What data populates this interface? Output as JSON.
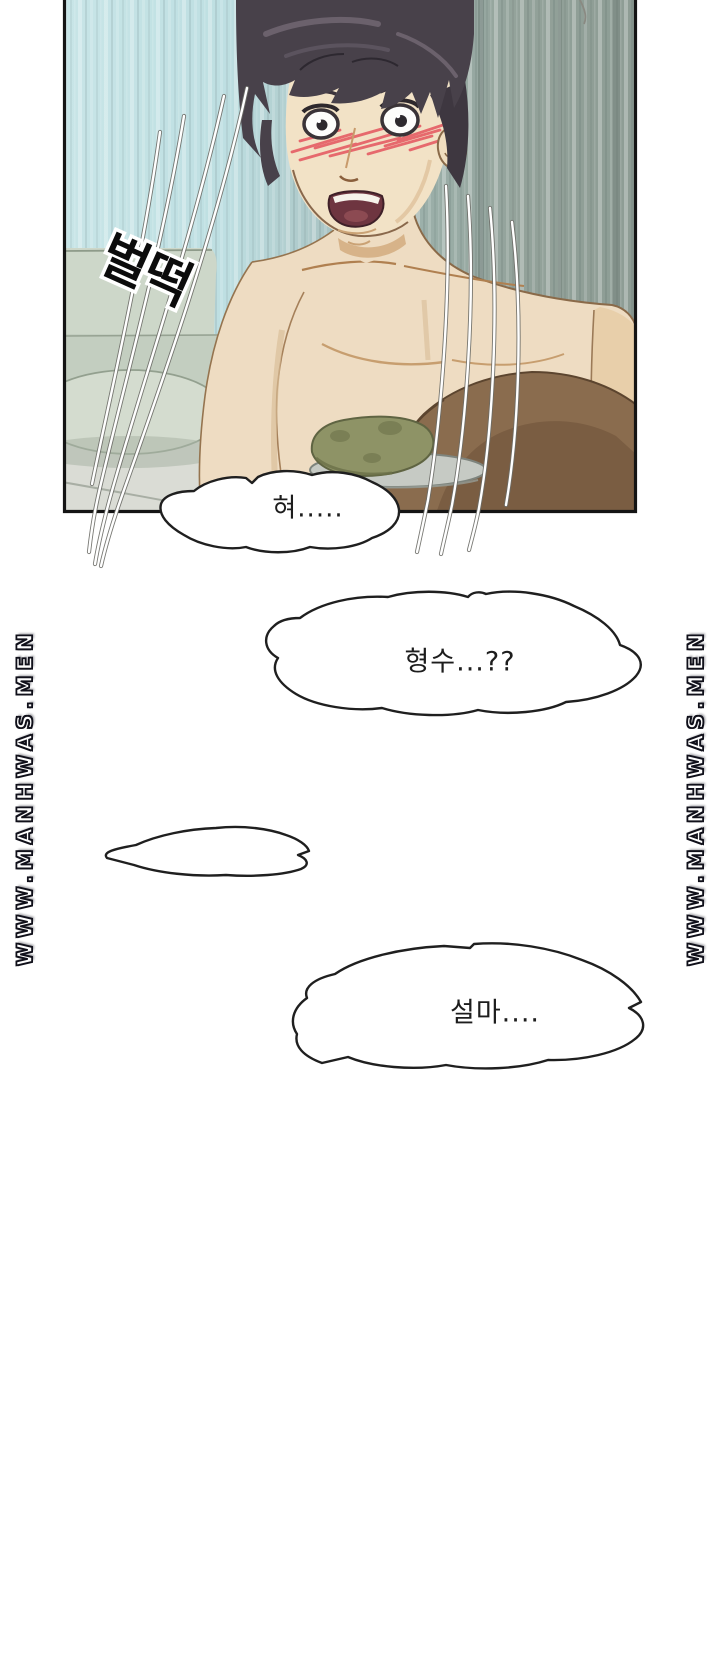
{
  "watermark": {
    "text": "WWW.MANHWAS.MEN",
    "fill": "#ffffff",
    "outline": "#10101a"
  },
  "panel": {
    "sfx": "벌떡"
  },
  "bubbles": {
    "b1": "혀.....",
    "b2": "형수...??",
    "b3": "",
    "b4": "설마...."
  },
  "colors": {
    "wall_left": "#c6e3e5",
    "wall_right": "#8d9c94",
    "couch": "#ccd6c8",
    "skin": "#eedcc2",
    "skin_shadow": "#d2ab7f",
    "hair": "#48414a",
    "blush": "#e4555e",
    "cushion_green": "#8e9366",
    "foreground_shadow": "#8a6c4e",
    "bubble_fill": "#ffffff",
    "bubble_stroke": "#1f1f1f",
    "panel_border": "#141414",
    "page_background": "#ffffff"
  }
}
